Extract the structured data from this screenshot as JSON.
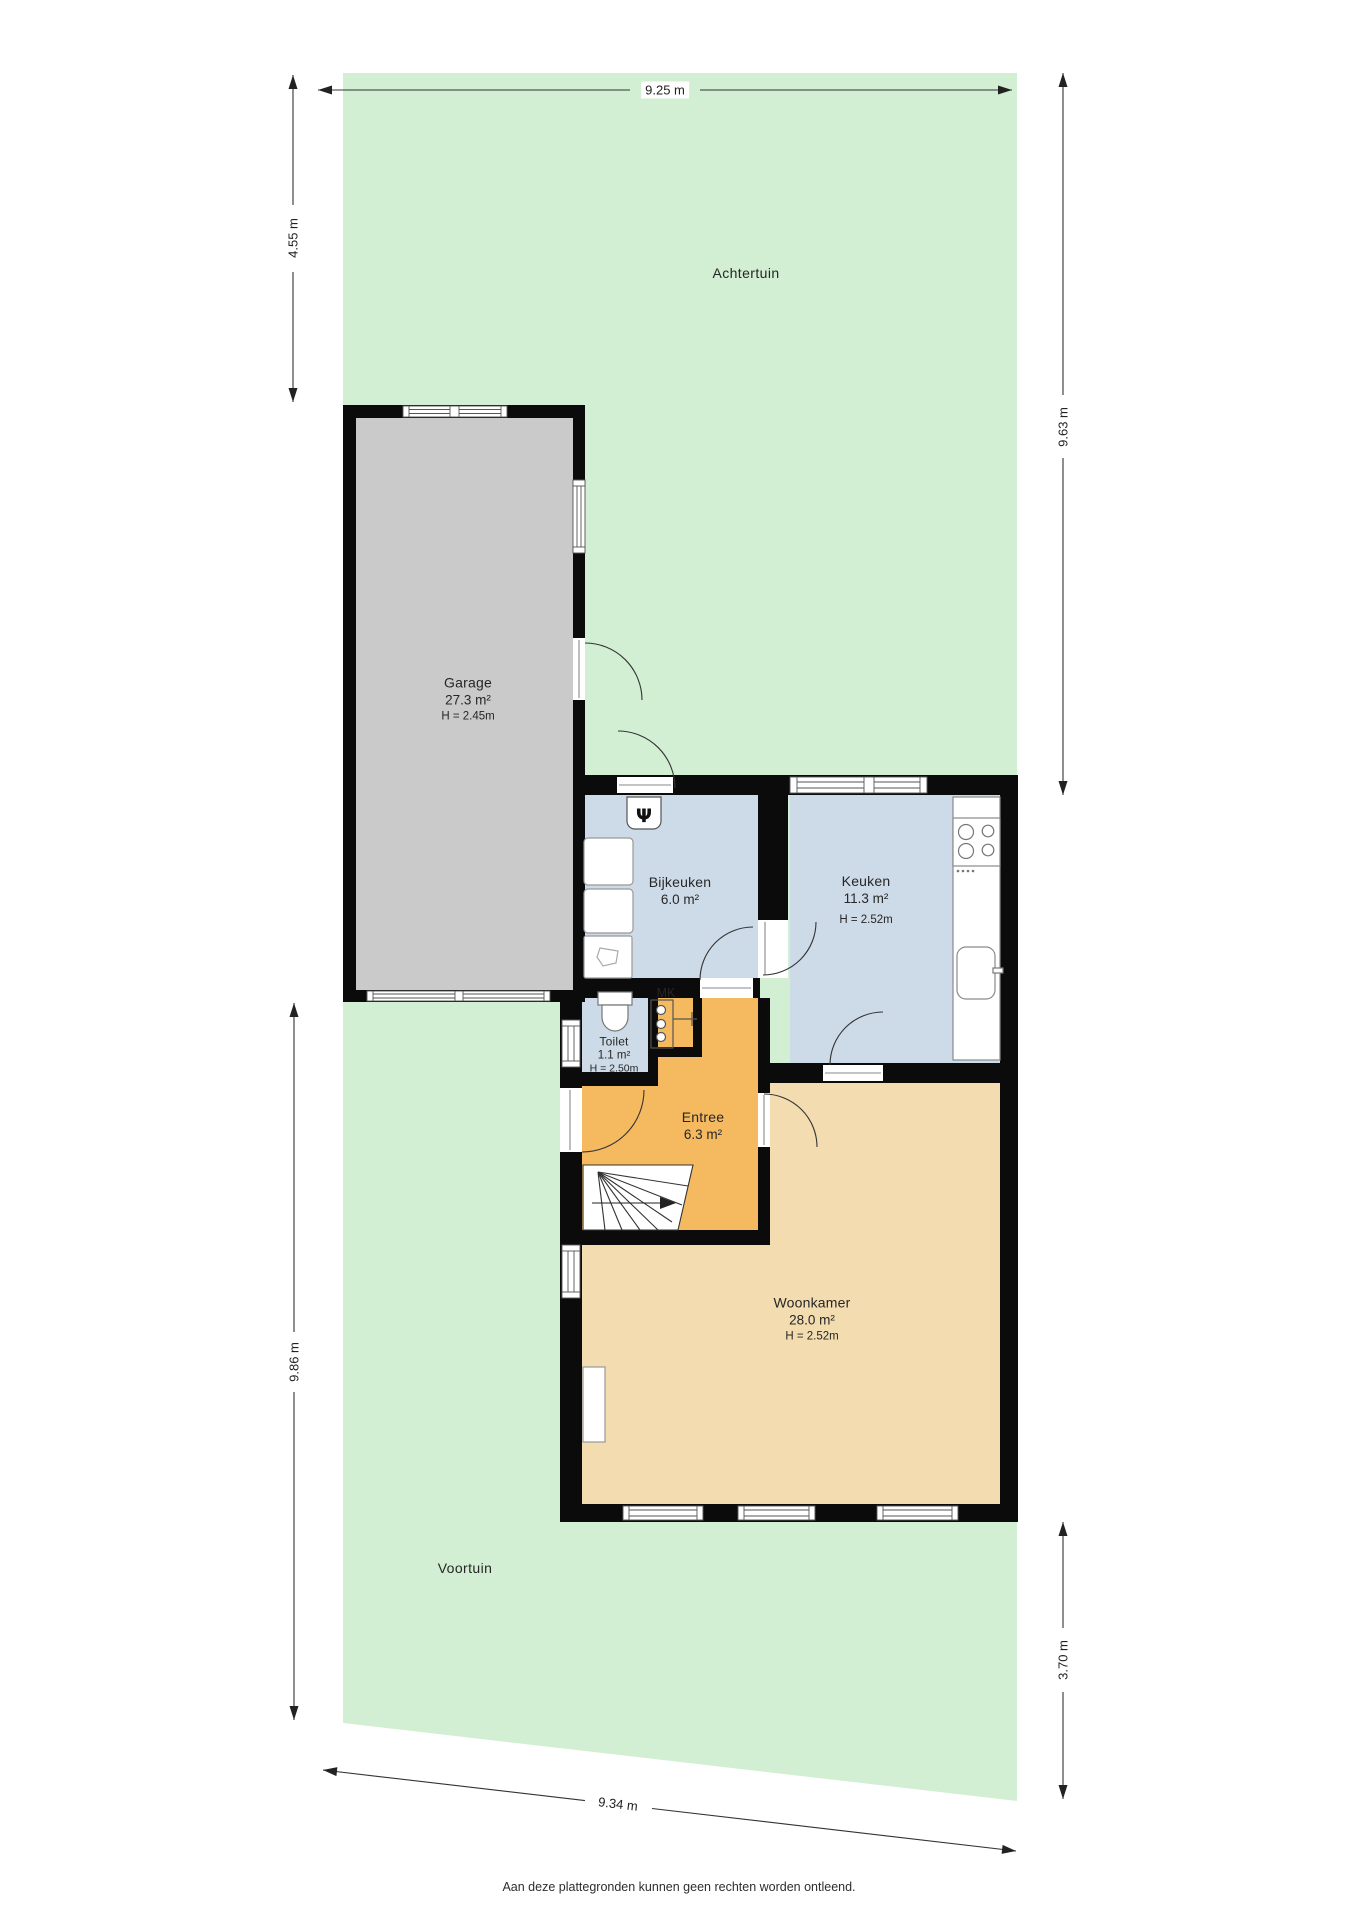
{
  "colors": {
    "garden": "#d2eed3",
    "garage_floor": "#cacaca",
    "wet_floor": "#cddbe9",
    "hall_floor": "#f5ba5f",
    "living_floor": "#f2dcb0",
    "wall": "#0b0b0b",
    "fixture_stroke": "#8a8a8a",
    "dimension": "#333333"
  },
  "icons": {
    "boiler_glyph": "Ψ"
  },
  "gardens": {
    "back_label": "Achtertuin",
    "front_label": "Voortuin"
  },
  "rooms": {
    "garage": {
      "name": "Garage",
      "area": "27.3 m²",
      "height": "H = 2.45m"
    },
    "bijkeuken": {
      "name": "Bijkeuken",
      "area": "6.0 m²"
    },
    "keuken": {
      "name": "Keuken",
      "area": "11.3 m²",
      "height": "H = 2.52m"
    },
    "toilet": {
      "name": "Toilet",
      "area": "1.1 m²",
      "height": "H = 2.50m"
    },
    "meter_closet": {
      "name": "MK"
    },
    "entree": {
      "name": "Entree",
      "area": "6.3 m²"
    },
    "woonkamer": {
      "name": "Woonkamer",
      "area": "28.0 m²",
      "height": "H = 2.52m"
    }
  },
  "dimensions": {
    "top": "9.25 m",
    "left_upper": "4.55 m",
    "left_lower": "9.86 m",
    "right_upper": "9.63 m",
    "right_lower": "3.70 m",
    "bottom": "9.34 m"
  },
  "footer": {
    "disclaimer": "Aan deze plattegronden kunnen geen rechten worden ontleend."
  }
}
